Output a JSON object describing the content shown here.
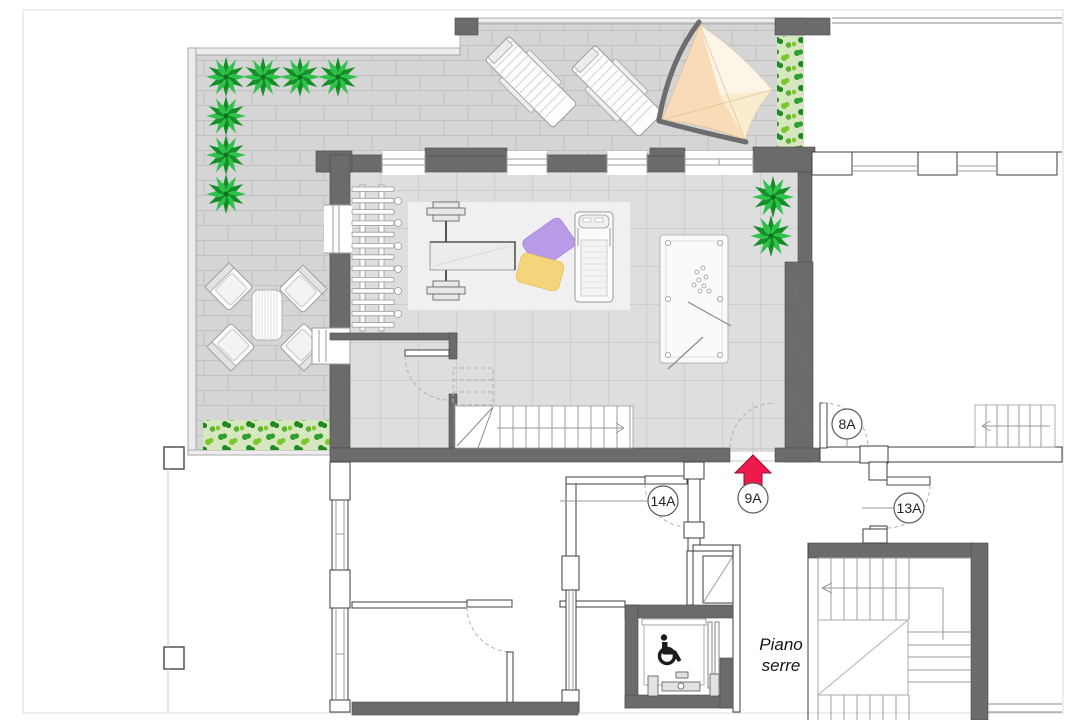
{
  "annotations": {
    "door_tags": [
      {
        "label": "8A"
      },
      {
        "label": "9A"
      },
      {
        "label": "14A"
      },
      {
        "label": "13A"
      }
    ],
    "floor_label": {
      "line1": "Piano",
      "line2": "serre"
    },
    "entrance_arrow": {
      "direction": "up",
      "color": "#ee1a4b"
    }
  },
  "palette": {
    "wall": "#6b6b6b",
    "terrace_paving": "#d5d5d5",
    "room_floor": "#dedede",
    "gym_mat": "#f0f0f0",
    "plant_green": "#1fa233",
    "hedge_bg": "#d7e7c0",
    "sail_canvas": "#f7dcb7",
    "pillow_purple": "#b89ae6",
    "pillow_yellow": "#f5d57b",
    "arrow_red": "#ee1a4b"
  },
  "furniture_icons": [
    "palm-plant-icon",
    "hedge-icon",
    "sun-lounger-icon",
    "shade-sail-icon",
    "outdoor-table-icon",
    "outdoor-chair-icon",
    "wall-bars-icon",
    "bench-press-icon",
    "pillow-icon",
    "treadmill-icon",
    "billiard-table-icon",
    "staircase-icon",
    "elevator-icon",
    "wheelchair-icon"
  ]
}
